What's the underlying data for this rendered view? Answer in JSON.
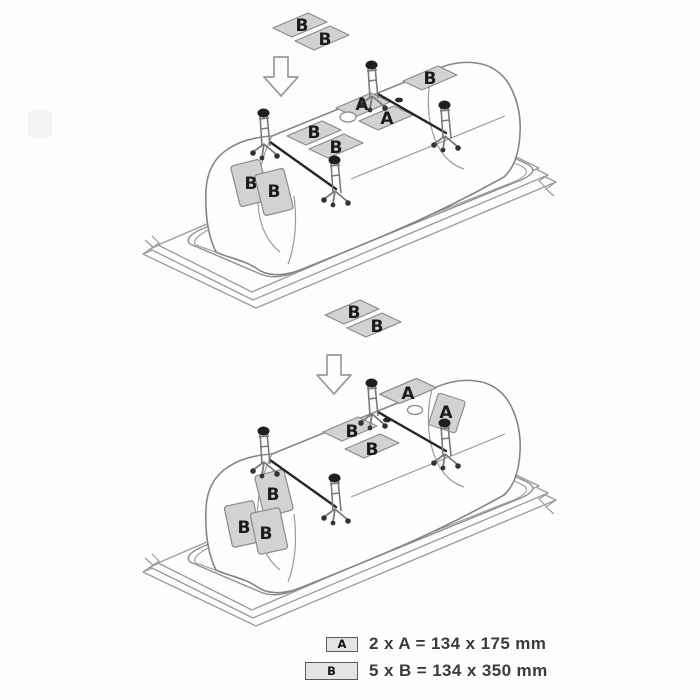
{
  "scene1": {
    "floating_pads": [
      "B",
      "B"
    ],
    "base_pads_a": [
      "A",
      "A"
    ],
    "base_pads_b": [
      "B",
      "B"
    ],
    "end_pad_right": [
      "B"
    ],
    "end_pads_left": [
      "B",
      "B"
    ]
  },
  "scene2": {
    "floating_pads": [
      "B",
      "B"
    ],
    "end_pads_right_a": [
      "A",
      "A"
    ],
    "base_pads_b": [
      "B",
      "B"
    ],
    "end_pads_left": [
      "B",
      "B",
      "B"
    ]
  },
  "legend": {
    "rows": [
      {
        "chip": "A",
        "text": "2 x A = 134 x 175 mm"
      },
      {
        "chip": "B",
        "text": "5 x B = 134 x 350 mm"
      }
    ]
  },
  "colors": {
    "pad_fill": "#d2d2d2",
    "line_art": "#8a8a8a",
    "dark_detail": "#262626",
    "background": "#fdfdfd"
  }
}
